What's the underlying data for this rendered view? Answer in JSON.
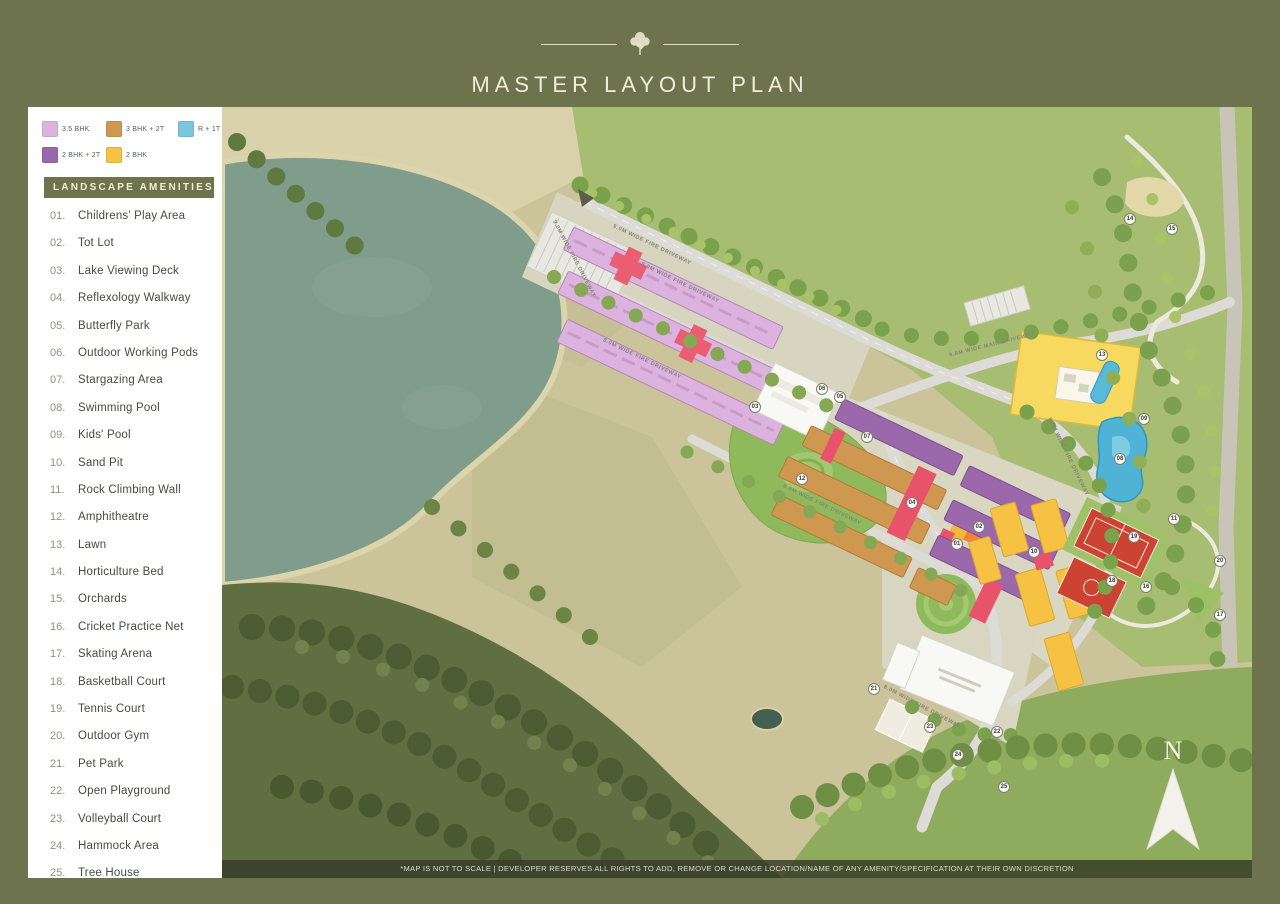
{
  "header": {
    "title": "MASTER LAYOUT PLAN"
  },
  "legend": {
    "items": [
      {
        "label": "3.5 BHK",
        "color": "#dcb3de"
      },
      {
        "label": "3 BHK + 2T",
        "color": "#cf9850"
      },
      {
        "label": "R + 1T",
        "color": "#7cc6dd"
      },
      {
        "label": "2 BHK + 2T",
        "color": "#9c68ac"
      },
      {
        "label": "2 BHK",
        "color": "#f5c243"
      }
    ]
  },
  "amenities": {
    "title": "LANDSCAPE AMENITIES",
    "items": [
      {
        "num": "01.",
        "label": "Childrens' Play Area"
      },
      {
        "num": "02.",
        "label": "Tot Lot"
      },
      {
        "num": "03.",
        "label": "Lake Viewing Deck"
      },
      {
        "num": "04.",
        "label": "Reflexology Walkway"
      },
      {
        "num": "05.",
        "label": "Butterfly Park"
      },
      {
        "num": "06.",
        "label": "Outdoor Working Pods"
      },
      {
        "num": "07.",
        "label": "Stargazing Area"
      },
      {
        "num": "08.",
        "label": "Swimming Pool"
      },
      {
        "num": "09.",
        "label": "Kids' Pool"
      },
      {
        "num": "10.",
        "label": "Sand Pit"
      },
      {
        "num": "11.",
        "label": "Rock Climbing Wall"
      },
      {
        "num": "12.",
        "label": "Amphitheatre"
      },
      {
        "num": "13.",
        "label": "Lawn"
      },
      {
        "num": "14.",
        "label": "Horticulture Bed"
      },
      {
        "num": "15.",
        "label": "Orchards"
      },
      {
        "num": "16.",
        "label": "Cricket Practice Net"
      },
      {
        "num": "17.",
        "label": "Skating Arena"
      },
      {
        "num": "18.",
        "label": "Basketball Court"
      },
      {
        "num": "19.",
        "label": "Tennis Court"
      },
      {
        "num": "20.",
        "label": "Outdoor Gym"
      },
      {
        "num": "21.",
        "label": "Pet Park"
      },
      {
        "num": "22.",
        "label": "Open Playground"
      },
      {
        "num": "23.",
        "label": "Volleyball Court"
      },
      {
        "num": "24.",
        "label": "Hammock Area"
      },
      {
        "num": "25.",
        "label": "Tree House"
      }
    ]
  },
  "map": {
    "north_label": "N",
    "disclaimer": "*MAP IS NOT TO SCALE | DEVELOPER RESERVES ALL RIGHTS TO ADD, REMOVE OR CHANGE LOCATION/NAME OF ANY AMENITY/SPECIFICATION AT THEIR OWN DISCRETION",
    "road_labels": [
      {
        "text": "9.0M WIDE FIRE DRIVEWAY",
        "x": 430,
        "y": 138,
        "a": 26
      },
      {
        "text": "9.0M WIDE FIRE DRIVEWAY",
        "x": 458,
        "y": 176,
        "a": 26
      },
      {
        "text": "8.0M WIDE FIRE DRIVEWAY",
        "x": 420,
        "y": 252,
        "a": 26
      },
      {
        "text": "9.0M WIDE MAIN DRIVEWAY",
        "x": 770,
        "y": 238,
        "a": -14
      },
      {
        "text": "8.0M WIDE FIRE DRIVEWAY",
        "x": 600,
        "y": 398,
        "a": 26
      },
      {
        "text": "8.0M WIDE FIRE DRIVEWAY",
        "x": 846,
        "y": 350,
        "a": 64
      },
      {
        "text": "8.0M WIDE FIRE DRIVEWAY",
        "x": 700,
        "y": 600,
        "a": 28
      },
      {
        "text": "9.0M WIDE FIRE DRIVEWAY",
        "x": 352,
        "y": 152,
        "a": 62
      }
    ],
    "markers": [
      {
        "n": "01",
        "x": 735,
        "y": 437
      },
      {
        "n": "02",
        "x": 757,
        "y": 420
      },
      {
        "n": "03",
        "x": 533,
        "y": 300
      },
      {
        "n": "04",
        "x": 690,
        "y": 396
      },
      {
        "n": "05",
        "x": 618,
        "y": 290
      },
      {
        "n": "06",
        "x": 600,
        "y": 282
      },
      {
        "n": "07",
        "x": 645,
        "y": 330
      },
      {
        "n": "08",
        "x": 898,
        "y": 352
      },
      {
        "n": "09",
        "x": 922,
        "y": 312
      },
      {
        "n": "10",
        "x": 812,
        "y": 445
      },
      {
        "n": "11",
        "x": 952,
        "y": 412
      },
      {
        "n": "12",
        "x": 580,
        "y": 372
      },
      {
        "n": "13",
        "x": 880,
        "y": 248
      },
      {
        "n": "14",
        "x": 908,
        "y": 112
      },
      {
        "n": "15",
        "x": 950,
        "y": 122
      },
      {
        "n": "16",
        "x": 924,
        "y": 480
      },
      {
        "n": "17",
        "x": 998,
        "y": 508
      },
      {
        "n": "18",
        "x": 890,
        "y": 474
      },
      {
        "n": "19",
        "x": 912,
        "y": 430
      },
      {
        "n": "20",
        "x": 998,
        "y": 454
      },
      {
        "n": "21",
        "x": 652,
        "y": 582
      },
      {
        "n": "22",
        "x": 775,
        "y": 625
      },
      {
        "n": "23",
        "x": 708,
        "y": 620
      },
      {
        "n": "24",
        "x": 736,
        "y": 648
      },
      {
        "n": "25",
        "x": 782,
        "y": 680
      }
    ]
  }
}
